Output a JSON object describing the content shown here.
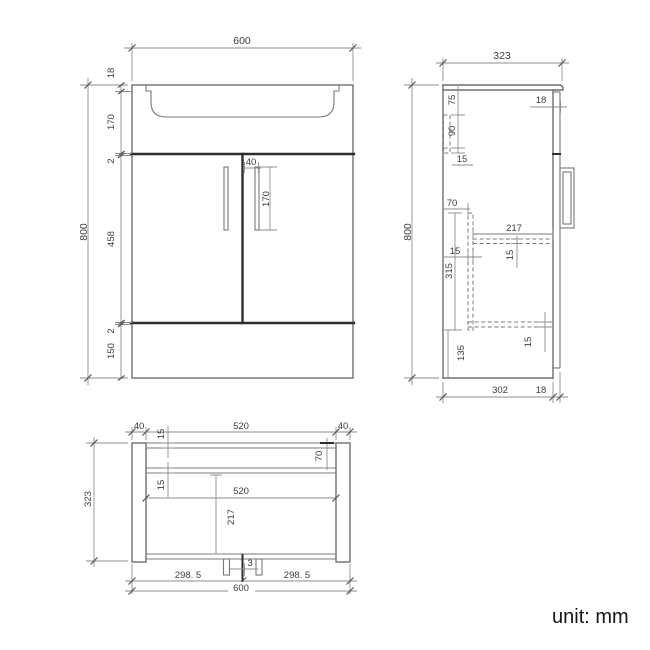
{
  "front_view": {
    "overall_width": "600",
    "overall_height": "800",
    "worktop_thickness": "18",
    "apron_height": "170",
    "top_gap": "2",
    "door_height": "458",
    "bottom_gap": "2",
    "plinth_height": "150",
    "handle_offset": "40",
    "handle_length": "170"
  },
  "side_view": {
    "overall_depth": "323",
    "overall_height": "800",
    "door_thickness_top": "18",
    "bracket_top_offset": "75",
    "bracket_height": "90",
    "bracket_thickness": "15",
    "panel_back_offset": "70",
    "panel_thickness": "15",
    "panel_height": "315",
    "shelf_depth": "217",
    "shelf_thickness": "15",
    "bottom_shelf_thickness": "15",
    "plinth_inner_height": "135",
    "carcass_depth": "302",
    "door_thickness_bottom": "18"
  },
  "plan_view": {
    "overall_depth": "323",
    "left_panel_width": "40",
    "back_rail_width": "520",
    "right_panel_width": "40",
    "back_rail_thickness": "15",
    "panel_back_offset": "70",
    "divider_thickness": "15",
    "interior_width": "520",
    "interior_depth": "217",
    "door_gap": "3",
    "left_door_width": "298. 5",
    "right_door_width": "298. 5",
    "overall_width": "600"
  },
  "footer": {
    "unit_note": "unit: mm"
  }
}
